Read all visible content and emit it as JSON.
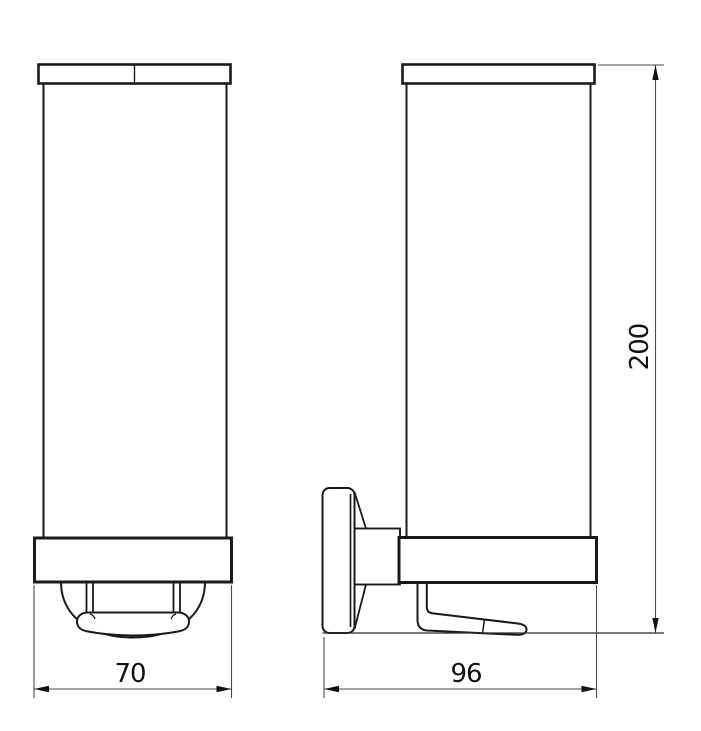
{
  "page": {
    "background": "#ffffff"
  },
  "drawing": {
    "object_line_color": "#1a1a1a",
    "dimension_line_color": "#4a4a4a",
    "text_color": "#111111",
    "dimensions": {
      "front_width": "70",
      "side_depth": "96",
      "overall_height": "200"
    }
  }
}
